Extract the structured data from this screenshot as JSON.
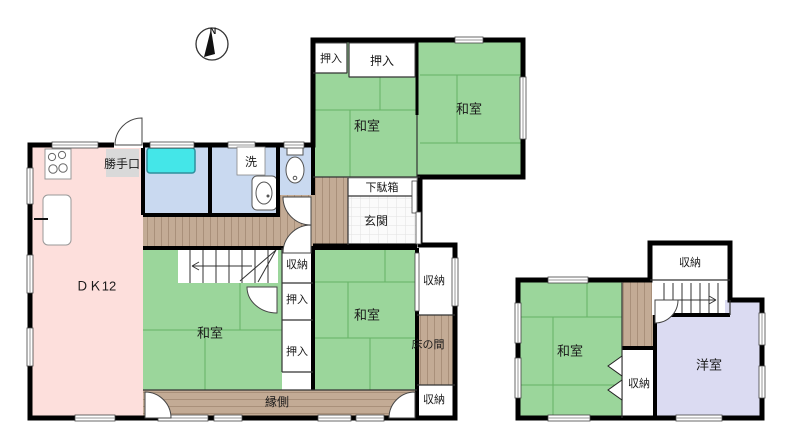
{
  "plan": {
    "compass": {
      "north": "N"
    },
    "main_house": {
      "dk": "ＤＫ12",
      "back_door": "勝手口",
      "laundry": "洗",
      "closet_top_small": "押入",
      "closet_top_wide": "押入",
      "washitsu_nw": "和室",
      "washitsu_ne": "和室",
      "shoe_cabinet": "下駄箱",
      "entrance": "玄関",
      "storage_hall": "収納",
      "closet_mid_upper": "押入",
      "closet_mid_lower": "押入",
      "washitsu_center": "和室",
      "washitsu_mid": "和室",
      "storage_east_top": "収納",
      "tokonoma": "床の間",
      "storage_east_bottom": "収納",
      "veranda": "縁側"
    },
    "annex": {
      "storage_top": "収納",
      "washitsu": "和室",
      "storage_mid": "収納",
      "western_room": "洋室"
    },
    "colors": {
      "tatami_green": "#9BD69B",
      "dk_pink": "#FDDFDC",
      "wet_area_blue": "#C9D9F0",
      "bathtub_cyan": "#44E6E8",
      "wood_brown": "#C3AB95",
      "western_lavender": "#DBDBF2",
      "label_gray": "#D9D9D9",
      "wall": "#000000"
    }
  }
}
